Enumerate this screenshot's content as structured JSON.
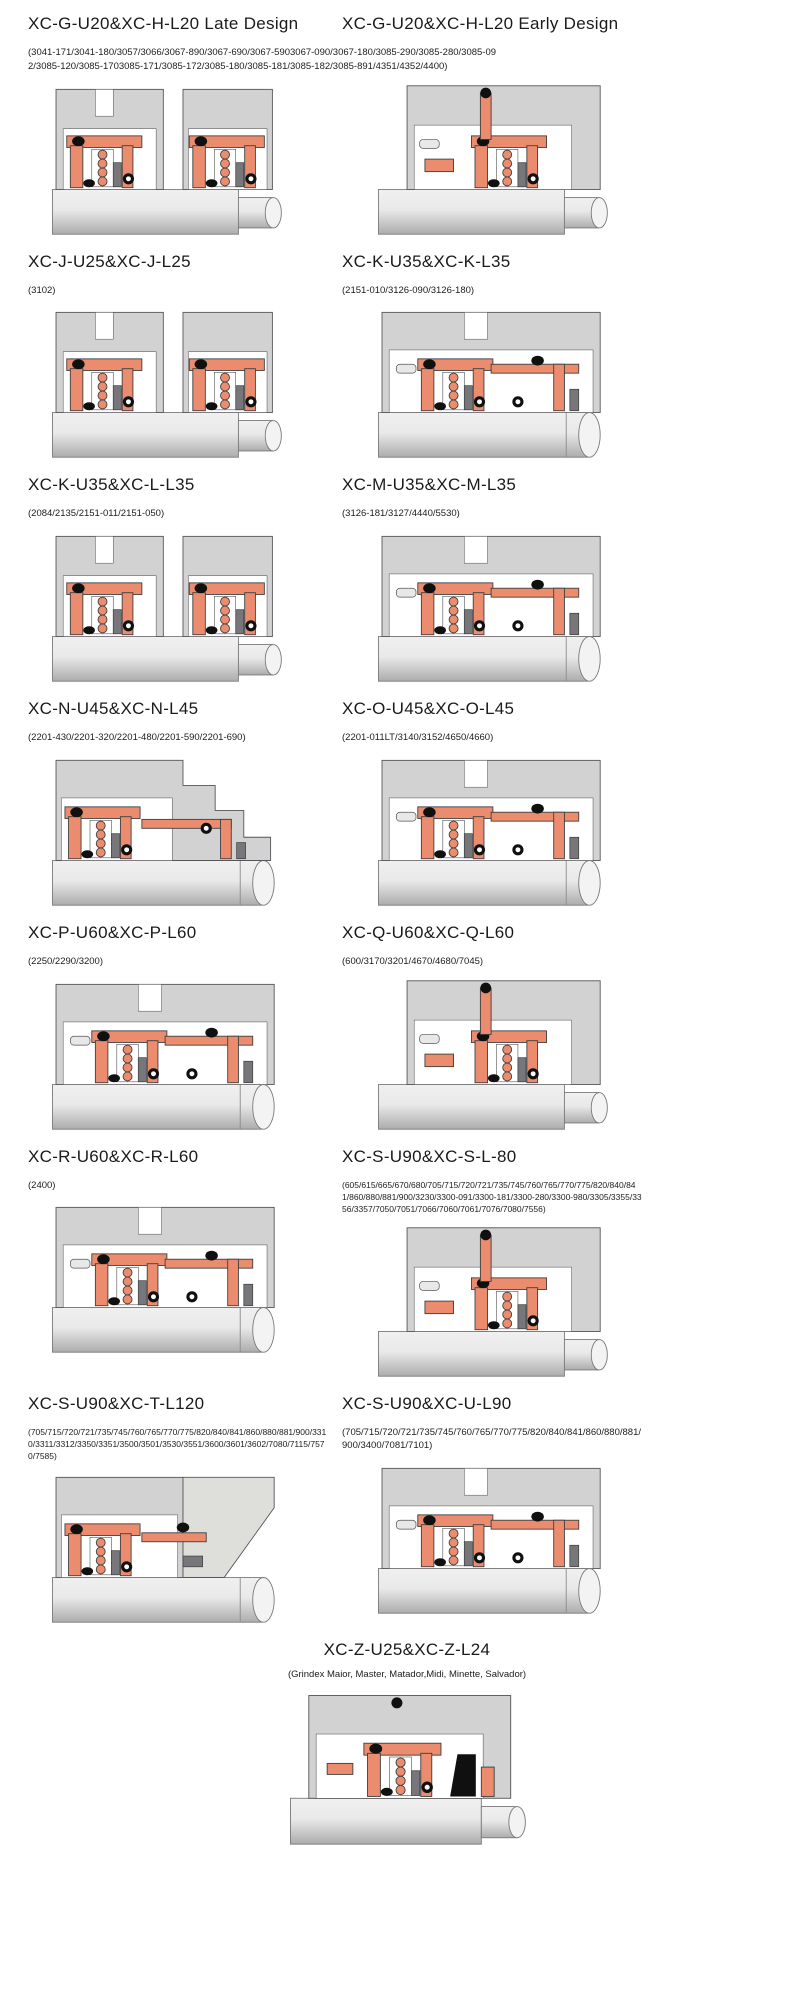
{
  "page": {
    "background": "#ffffff",
    "description": "Mechanical seal cross-section catalog page"
  },
  "colors": {
    "background": "#ffffff",
    "housing_gray": "#d2d2d2",
    "housing_stroke": "#55555a",
    "seal_salmon": "#ea8c6d",
    "seal_stroke": "#3f3f3f",
    "elastomer_black": "#101010",
    "face_gray": "#76767b",
    "shaft_light": "#e9e9e9",
    "shaft_dark": "#acacac",
    "wedge_gray": "#dededa",
    "text_color": "#1a1a1a"
  },
  "sections": [
    {
      "title": "XC-G-U20&XC-H-L20 Late Design",
      "parts": "(3041-171/3041-180/3057/3066/3067-890/3067-690/3067-5903067-090/3067-180/3085-290/3085-280/3085-092/3085-120/3085-1703085-171/3085-172/3085-180/3085-181/3085-182/3085-891/4351/4352/4400)",
      "diagram_variant": "twin"
    },
    {
      "title": "XC-G-U20&XC-H-L20 Early Design",
      "parts": "",
      "diagram_variant": "tall"
    },
    {
      "title": "XC-J-U25&XC-J-L25",
      "parts": "(3102)",
      "diagram_variant": "twin"
    },
    {
      "title": "XC-K-U35&XC-K-L35",
      "parts": "(2151-010/3126-090/3126-180)",
      "diagram_variant": "wide"
    },
    {
      "title": "XC-K-U35&XC-L-L35",
      "parts": "(2084/2135/2151-011/2151-050)",
      "diagram_variant": "twin"
    },
    {
      "title": "XC-M-U35&XC-M-L35",
      "parts": "(3126-181/3127/4440/5530)",
      "diagram_variant": "wide"
    },
    {
      "title": "XC-N-U45&XC-N-L45",
      "parts": "(2201-430/2201-320/2201-480/2201-590/2201-690)",
      "diagram_variant": "step"
    },
    {
      "title": "XC-O-U45&XC-O-L45",
      "parts": "(2201-011LT/3140/3152/4650/4660)",
      "diagram_variant": "wide"
    },
    {
      "title": "XC-P-U60&XC-P-L60",
      "parts": "(2250/2290/3200)",
      "diagram_variant": "wide"
    },
    {
      "title": "XC-Q-U60&XC-Q-L60",
      "parts": "(600/3170/3201/4670/4680/7045)",
      "diagram_variant": "tall"
    },
    {
      "title": "XC-R-U60&XC-R-L60",
      "parts": "(2400)",
      "diagram_variant": "wide"
    },
    {
      "title": "XC-S-U90&XC-S-L-80",
      "parts": "(605/615/665/670/680/705/715/720/721/735/745/760/765/770/775/820/840/841/860/880/881/900/3230/3300-091/3300-181/3300-280/3300-980/3305/3355/3356/3357/7050/7051/7066/7060/7061/7076/7080/7556)",
      "diagram_variant": "tall"
    },
    {
      "title": "XC-S-U90&XC-T-L120",
      "parts": "(705/715/720/721/735/745/760/765/770/775/820/840/841/860/880/881/900/3310/3311/3312/3350/3351/3500/3501/3530/3551/3600/3601/3602/7080/7115/7570/7585)",
      "diagram_variant": "wedge"
    },
    {
      "title": "XC-S-U90&XC-U-L90",
      "parts": "(705/715/720/721/735/745/760/765/770/775/820/840/841/860/880/881/900/3400/7081/7101)",
      "diagram_variant": "wide"
    },
    {
      "title": "XC-Z-U25&XC-Z-L24",
      "parts": "(Grindex  Maior, Master, Matador,Midi, Minette, Salvador)",
      "diagram_variant": "center"
    }
  ]
}
